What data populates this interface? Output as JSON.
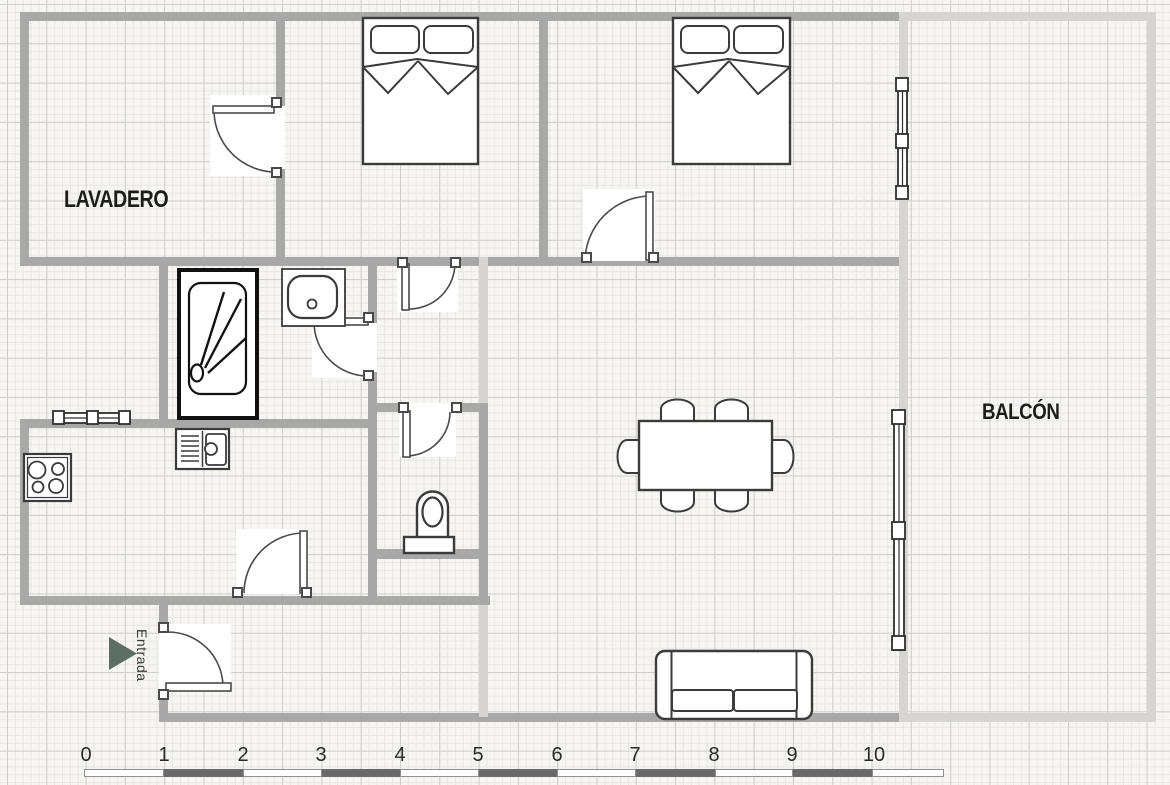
{
  "labels": {
    "lavadero": "LAVADERO",
    "balcon": "BALCÓN",
    "entrada": "Entrada"
  },
  "rooms_annotated": [
    "LAVADERO",
    "BALCÓN"
  ],
  "entrance_marker": {
    "text": "Entrada",
    "arrow_direction": "right"
  },
  "ruler": {
    "labels": [
      "0",
      "1",
      "2",
      "3",
      "4",
      "5",
      "6",
      "7",
      "8",
      "9",
      "10"
    ],
    "unit_px": 78.6,
    "origin_px": 86
  },
  "fixtures": [
    "double-bed-1",
    "double-bed-2",
    "shower",
    "bathroom-sink",
    "toilet",
    "kitchen-sink",
    "cooktop",
    "dining-table",
    "six-chairs",
    "sofa"
  ],
  "openings": [
    "lavadero-door",
    "bedroom1-door",
    "bedroom2-door",
    "bathroom-door",
    "wc-door",
    "kitchen-door",
    "entrance-door",
    "bedroom2-window",
    "livingroom-window",
    "kitchen-window"
  ],
  "colors": {
    "paper": "#f6f5f2",
    "grid_minor": "#e8e7e4",
    "grid_major": "#cfcecb",
    "wall_main": "#a8a8a8",
    "wall_light": "#d6d5d2",
    "stroke": "#3b3b3b",
    "arrow": "#5e6e65",
    "scale_dark": "#6a6a6a",
    "text": "#1c1c1c"
  }
}
